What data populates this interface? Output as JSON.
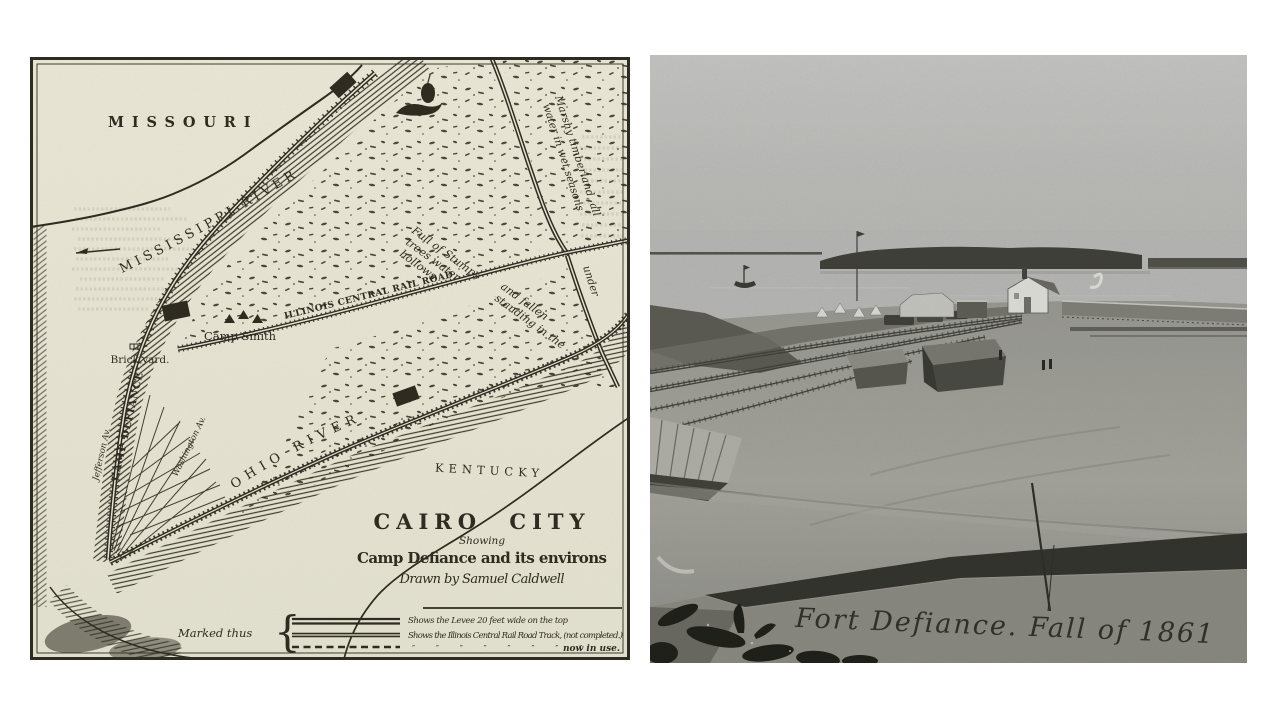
{
  "page": {
    "background": "#ffffff",
    "description": "Two historical images side by side: an 1861 engraved map of Cairo City and a photograph of Fort Defiance"
  },
  "map": {
    "colors": {
      "paper": "#e9e7d6",
      "ink": "#2b291d"
    },
    "regions": {
      "missouri": "MISSOURI",
      "kentucky": "KENTUCKY"
    },
    "rivers": {
      "mississippi": "MISSISSIPPI RIVER",
      "ohio": "OHIO RIVER"
    },
    "features": {
      "railroad": "ILLINOIS CENTRAL RAIL ROAD",
      "camp_smith": "Camp Smith",
      "brick_yard": "Brick yard.",
      "camp_defiance": "CAMP DEFIANCE",
      "jefferson_av": "Jefferson Av.",
      "washington_av": "Washington Av."
    },
    "notes": {
      "marshy_1": "Marshy timberland, all",
      "marshy_2": "water in wet seasons",
      "marshy_3": "under",
      "stumps_1": "Full of Stumps",
      "stumps_2": "trees water",
      "stumps_3": "hollows",
      "stumps_4": "and fallen",
      "stumps_5": "standing in the"
    },
    "title": {
      "main": "CAIRO CITY",
      "showing": "Showing",
      "subtitle": "Camp Defiance and its environs",
      "credit": "Drawn by Samuel Caldwell"
    },
    "legend": {
      "intro": "Marked thus",
      "brace": "{",
      "items": [
        "Shows the Levee 20 feet wide on the top",
        "Shows the Illinois Central Rail Road Track, (not completed.)",
        "now in use."
      ],
      "dittos": "″ ″ ″ ″ ″ ″ ″ ″"
    }
  },
  "photo": {
    "caption": "Fort Defiance. Fall of 1861",
    "tones": {
      "sky": "#cfcfcc",
      "water": "#c2c2bf",
      "trees": "#3b3b33",
      "ground": "#a5a59d",
      "shadow": "#2c2c26"
    }
  }
}
